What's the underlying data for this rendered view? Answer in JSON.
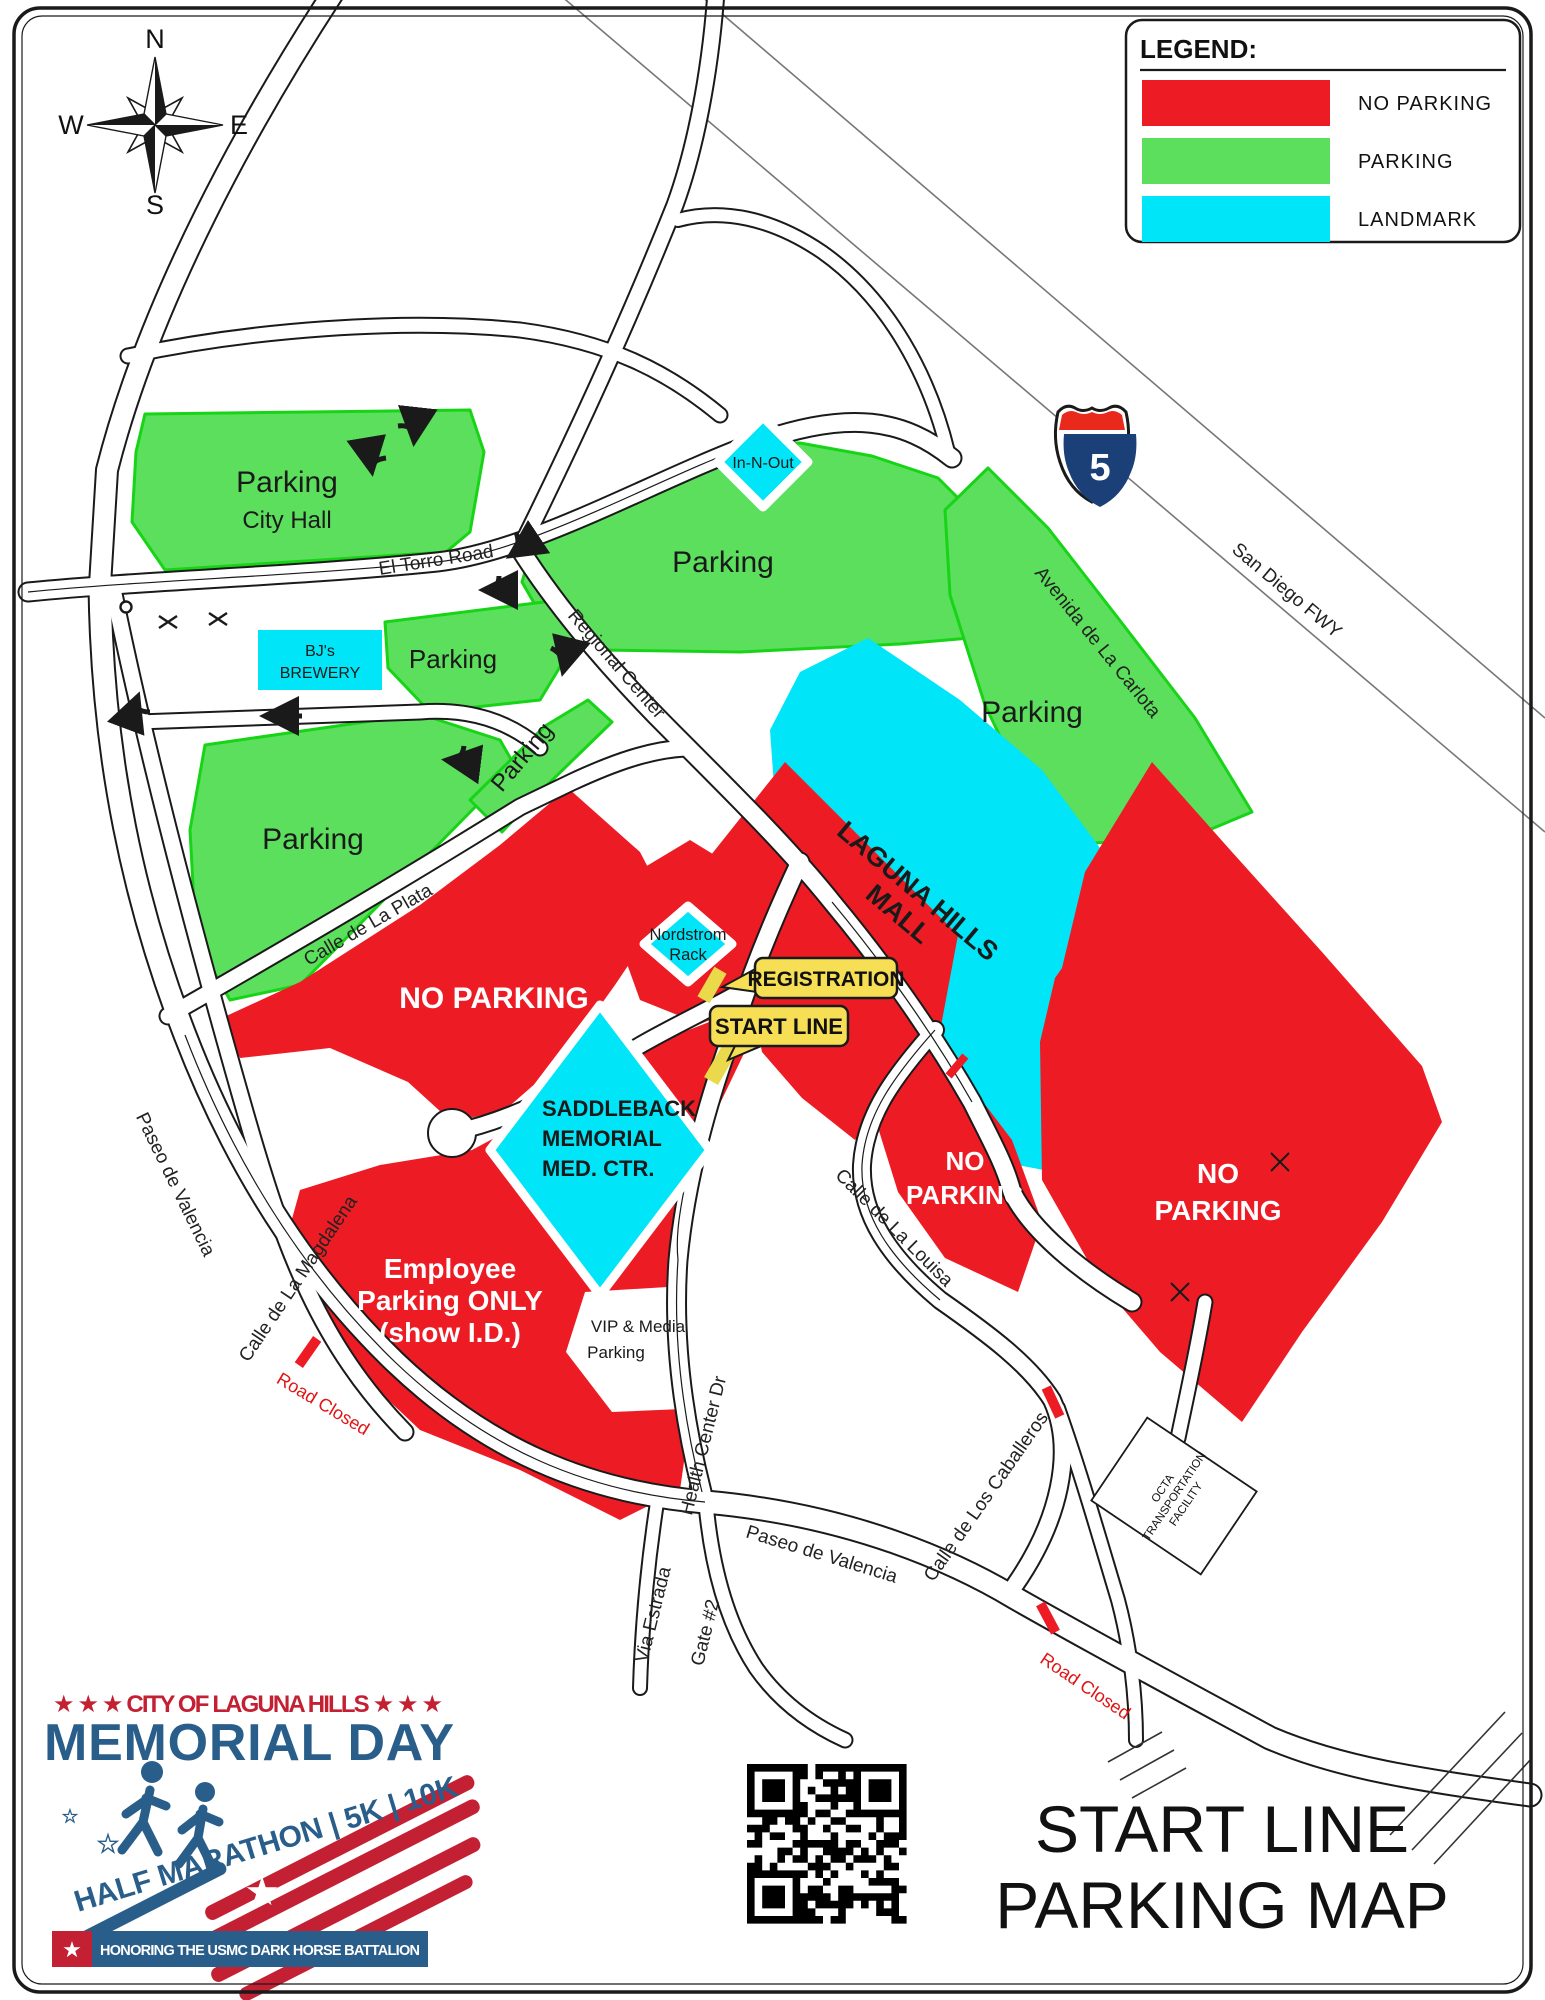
{
  "page": {
    "background": "#ffffff",
    "border_color": "#1a1a1a"
  },
  "legend": {
    "title": "LEGEND:",
    "items": [
      {
        "label": "NO  PARKING",
        "color": "#ED1C24"
      },
      {
        "label": "PARKING",
        "color": "#5CDF5C"
      },
      {
        "label": "LANDMARK",
        "color": "#00E5F8"
      }
    ]
  },
  "compass": {
    "north": "N",
    "east": "E",
    "south": "S",
    "west": "W"
  },
  "freeway": {
    "shield_number": "5",
    "name": "San Diego FWY"
  },
  "roads": {
    "el_torro": "El Torro Road",
    "regional_center": "Regional Center",
    "avenida": "Avenida de La Carlota",
    "calle_de_la_plata": "Calle de La Plata",
    "paseo_de_valencia_1": "Paseo de Valencia",
    "paseo_de_valencia_2": "Paseo de Valencia",
    "calle_de_la_magdalena": "Calle de La Magdalena",
    "calle_de_la_louisa": "Calle de La Louisa",
    "calle_de_los_caballeros": "Calle de Los Caballeros",
    "health_center_dr": "Health Center Dr",
    "via_estrada": "Via Estrada",
    "gate_2": "Gate #2"
  },
  "notices": {
    "road_closed_1": "Road Closed",
    "road_closed_2": "Road Closed"
  },
  "zones": {
    "city_hall": {
      "line1": "Parking",
      "line2": "City Hall"
    },
    "parking_mid": {
      "label": "Parking"
    },
    "parking_right": {
      "label": "Parking"
    },
    "parking_left": {
      "label": "Parking"
    },
    "parking_bjs_lot": {
      "label": "Parking"
    },
    "parking_strip": {
      "label": "Parking"
    },
    "no_parking_west": {
      "label": "NO PARKING"
    },
    "no_parking_small": {
      "line1": "NO",
      "line2": "PARKING"
    },
    "no_parking_east": {
      "line1": "NO",
      "line2": "PARKING"
    },
    "employee": {
      "line1": "Employee",
      "line2": "Parking ONLY",
      "line3": "(show I.D.)"
    },
    "vip": {
      "line1": "VIP & Media",
      "line2": "Parking"
    }
  },
  "landmarks": {
    "in_n_out": {
      "label": "In-N-Out"
    },
    "bjs": {
      "line1": "BJ's",
      "line2": "BREWERY"
    },
    "mall": {
      "line1": "LAGUNA HILLS",
      "line2": "MALL"
    },
    "nordstrom": {
      "line1": "Nordstrom",
      "line2": "Rack"
    },
    "saddleback": {
      "line1": "SADDLEBACK",
      "line2": "MEMORIAL",
      "line3": "MED. CTR."
    },
    "octa": {
      "line1": "OCTA",
      "line2": "TRANSPORTATION",
      "line3": "FACILITY"
    }
  },
  "badges": {
    "registration": "REGISTRATION",
    "start_line": "START LINE"
  },
  "logo": {
    "tagline_top": "★ ★ ★  CITY OF LAGUNA HILLS  ★ ★ ★",
    "title": "MEMORIAL DAY",
    "race_line": "HALF MARATHON | 5K | 10K",
    "banner": "HONORING THE USMC DARK HORSE BATTALION",
    "star_icon": "★",
    "red": "#C32033",
    "blue": "#2A5E8A"
  },
  "title": {
    "line1": "START LINE",
    "line2": "PARKING MAP"
  }
}
